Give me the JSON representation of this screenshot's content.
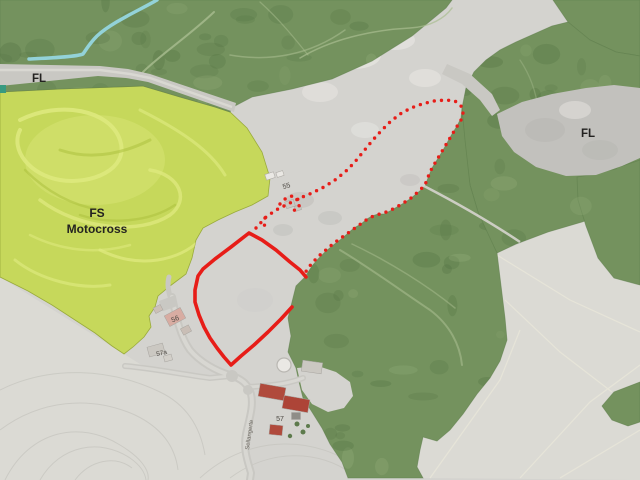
{
  "map": {
    "zone_labels": {
      "fl_top": "FL",
      "fl_right": "FL",
      "fs_line1": "FS",
      "fs_line2": "Motocross"
    },
    "house_numbers": {
      "n55": "55",
      "n56": "56",
      "n57": "57",
      "n57a": "57a"
    },
    "road_name": "Sellangerte",
    "colors": {
      "fieldBase": "#d4d3cf",
      "fieldLight": "#dbdad4",
      "forest": "#74925e",
      "forestDark": "#4e6e3e",
      "forestLight": "#9ab37e",
      "meadow": "#c6d85b",
      "meadowLight": "#dde97d",
      "meadowDark": "#aec23f",
      "clearing": "#c2c1bd",
      "road": "#c9c8c3",
      "roadLight": "#dad9d4",
      "red": "#e71d18",
      "stream": "#93d2d8",
      "buildingRed": "#b04a3c",
      "buildingRed2": "#ad4437",
      "buildingGray": "#cbc8c2",
      "buildingWhite": "#eae8e4",
      "textDark": "#232220",
      "textGray": "#4c4842",
      "tealPatch": "#379a80"
    }
  }
}
